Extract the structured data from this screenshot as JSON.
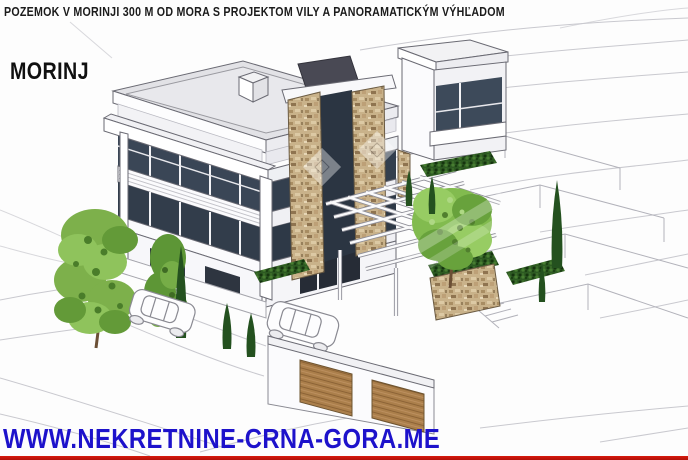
{
  "header": {
    "caption": "POZEMOK V MORINJI 300 M OD MORA S PROJEKTOM VILY A PANORAMATICKÝM VÝHĽADOM"
  },
  "overlay": {
    "location_label": "MORINJ"
  },
  "footer": {
    "website_url": "WWW.NEKRETNINE-CRNA-GORA.ME"
  },
  "colors": {
    "caption_text": "#1b1b1b",
    "location_text": "#101010",
    "url_text": "#1d12cb",
    "bottom_bar": "#c4170c",
    "glass_dark": "#36414f",
    "stone": "#c9b28a",
    "wood_door": "#ab7f4b",
    "foliage": "#7db04b",
    "cypress": "#24511f",
    "roof_gray": "#e2e2e6",
    "sketch_line": "#c9c9cf"
  },
  "illustration": {
    "watermark_icon": "diamond-watermark",
    "scene_icons": [
      "villa-sketch",
      "stone-tower",
      "pergola",
      "tree",
      "cypress-tree",
      "car-sketch",
      "garage-door",
      "terrace-wall"
    ]
  }
}
